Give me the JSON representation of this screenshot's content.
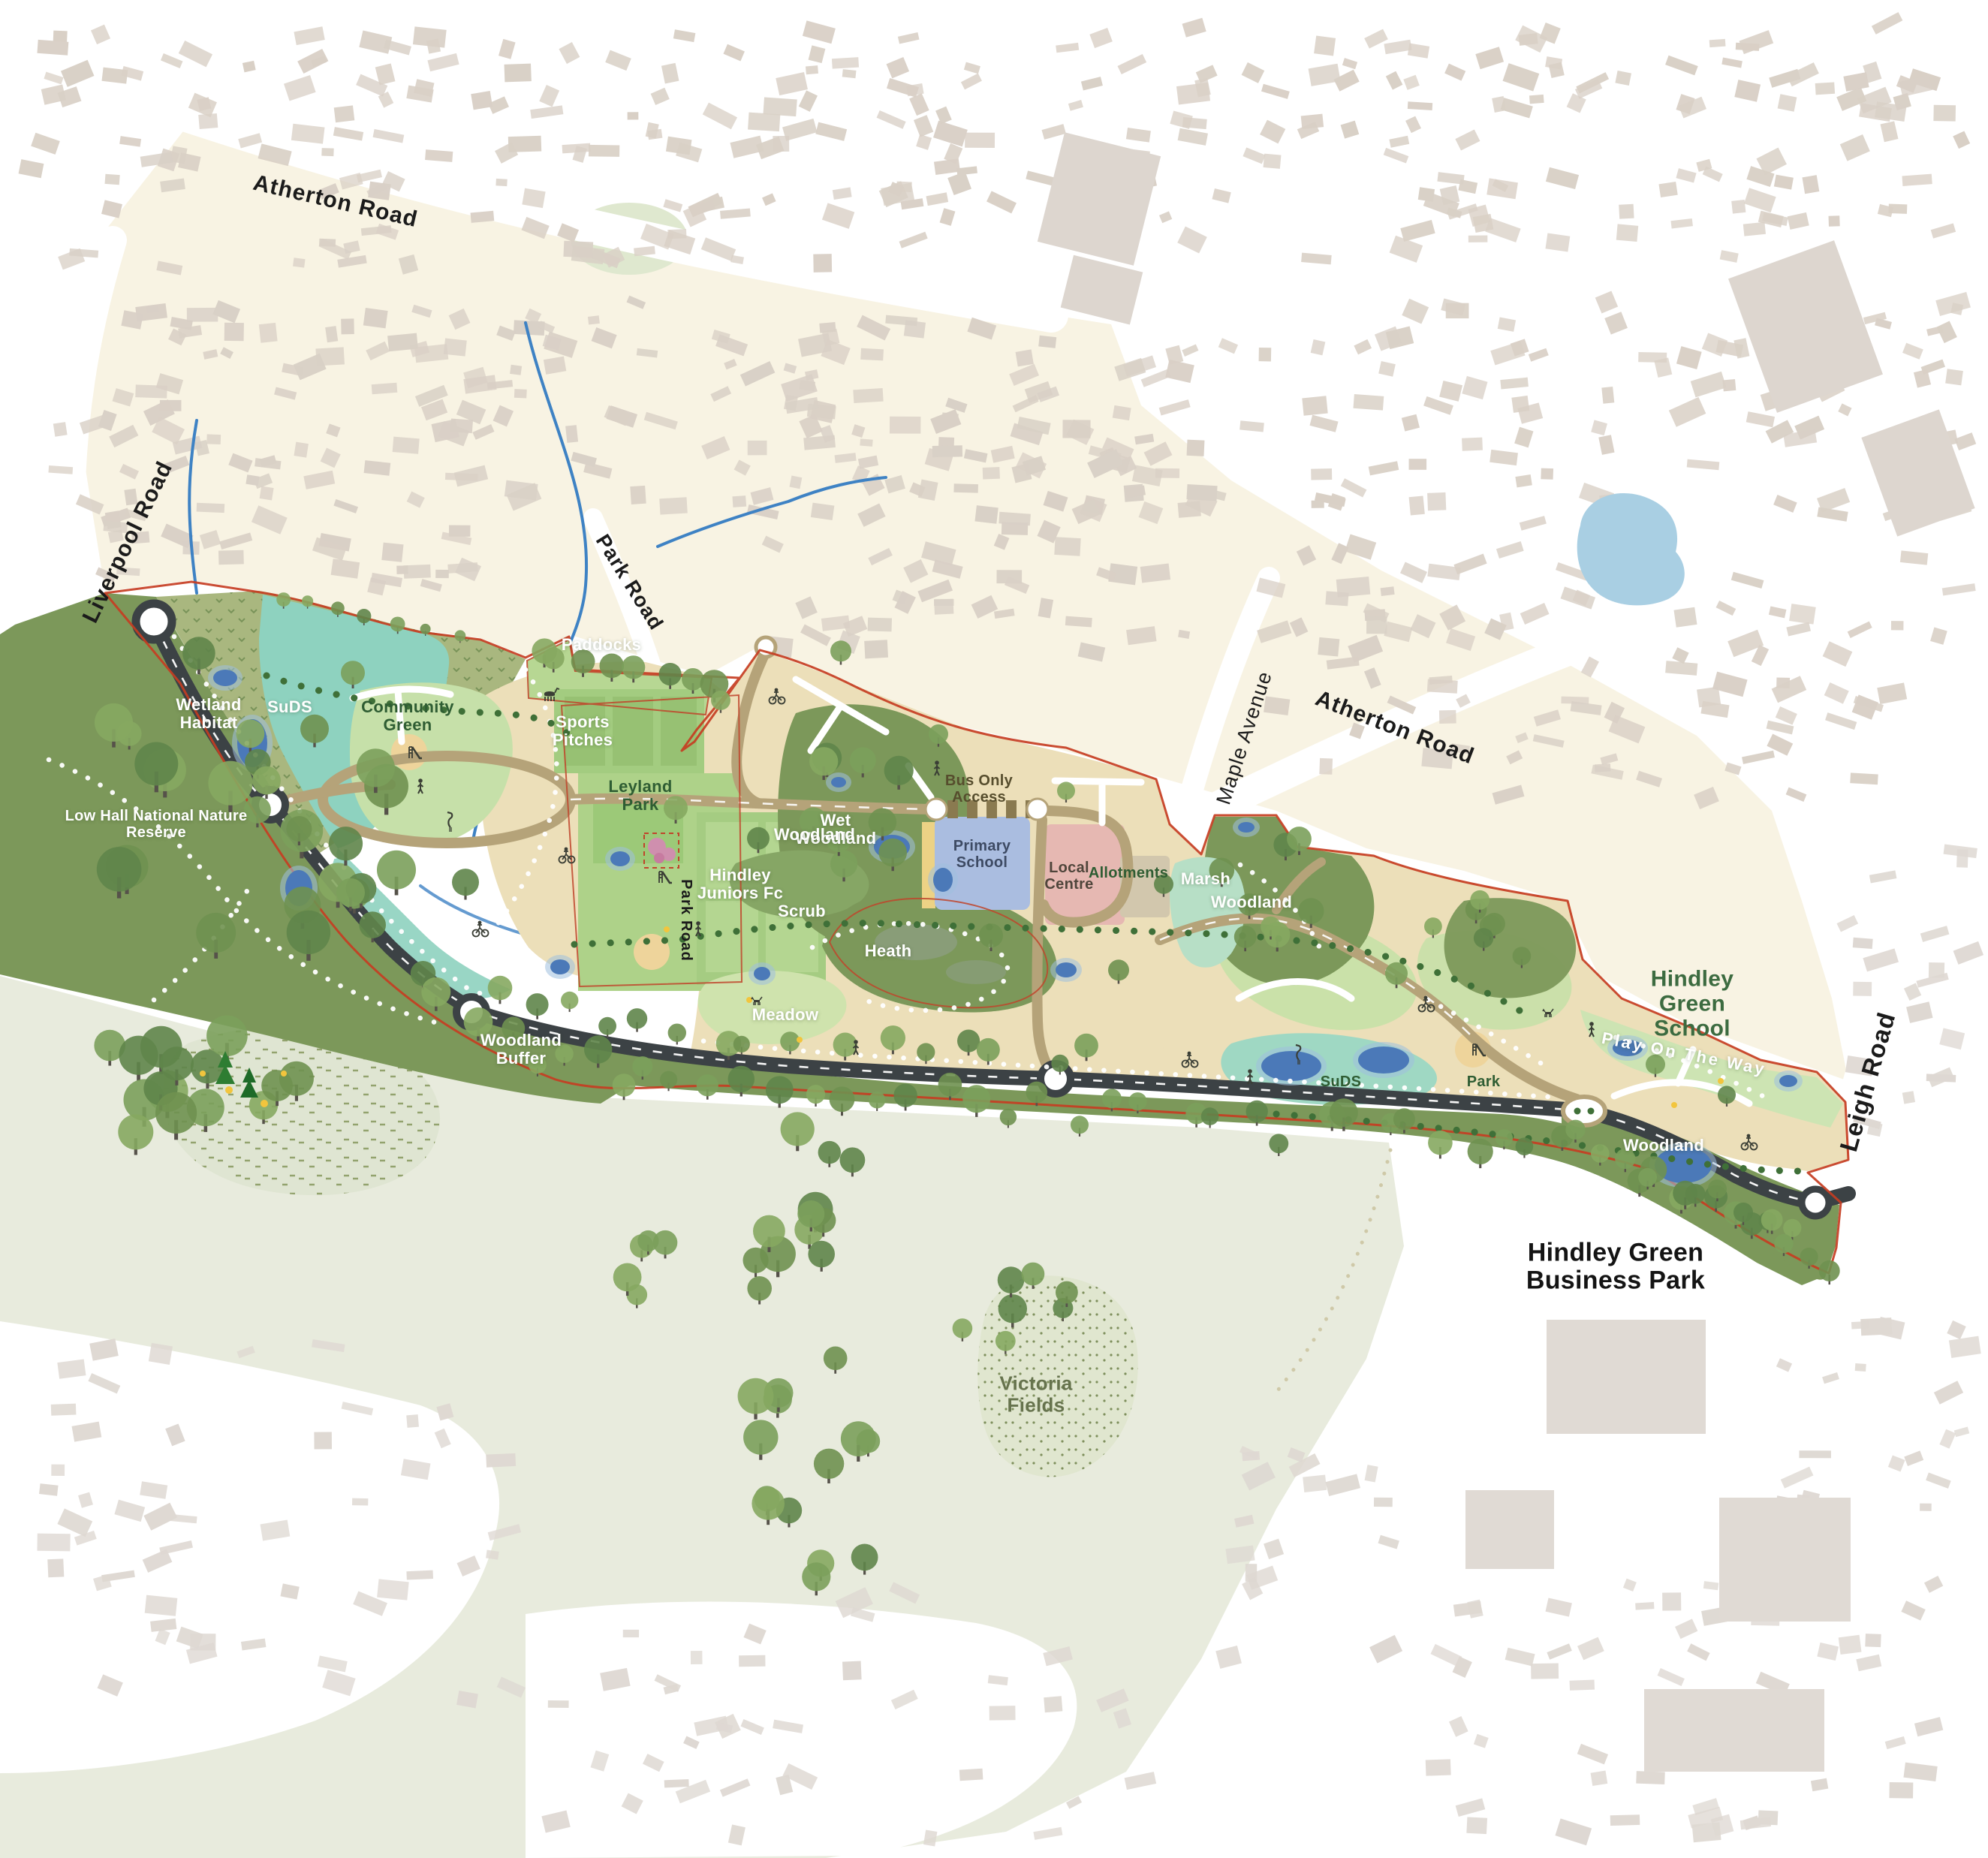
{
  "map_type": "illustrative-masterplan",
  "road_labels": {
    "atherton_road_west": "Atherton Road",
    "liverpool_road": "Liverpool Road",
    "park_road_upper": "Park Road",
    "park_road_lower": "Park Road",
    "maple_avenue": "Maple Avenue",
    "atherton_road_east": "Atherton Road",
    "leigh_road": "Leigh Road"
  },
  "site_labels": {
    "wetland_habitat": "Wetland Habitat",
    "suds_west": "SuDS",
    "community_green": "Community Green",
    "low_hall_reserve": "Low Hall National Nature Reserve",
    "paddocks": "Paddocks",
    "sports_pitches": "Sports Pitches",
    "leyland_park": "Leyland Park",
    "wet_woodland": "Wet Woodland",
    "hindley_juniors_fc": "Hindley Juniors Fc",
    "scrub": "Scrub",
    "heath": "Heath",
    "meadow": "Meadow",
    "bus_only_access": "Bus Only Access",
    "primary_school": "Primary School",
    "local_centre": "Local Centre",
    "allotments": "Allotments",
    "marsh": "Marsh",
    "woodland_north": "Woodland",
    "woodland_ne": "Woodland",
    "woodland_buffer": "Woodland Buffer",
    "suds_east": "SuDS",
    "park_east": "Park",
    "play_on_the_way": "Play On The Way",
    "woodland_se": "Woodland",
    "victoria_fields": "Victoria Fields"
  },
  "context_labels": {
    "hindley_green_school": "Hindley Green School",
    "hindley_green_business_park": "Hindley Green Business Park"
  },
  "colors": {
    "boundary_red": "#c63d22",
    "road_dark": "#3c4245",
    "road_tan": "#b5a379",
    "parcel_beige": "#ecdfb9",
    "woodland_olive": "#7c985a",
    "wetland_olive": "#a9b77f",
    "park_green": "#a5cc82",
    "park_light": "#cfe5b4",
    "wetland_teal": "#8ed2bf",
    "pond_blue": "#4b79b8",
    "lake_blue": "#a9cfe3",
    "school_blue": "#aabde0",
    "local_centre_pink": "#e6b8b2",
    "playground_sand": "#eed49b",
    "urban_cream": "#f8f3e3",
    "building_taupe": "#d9d0c6",
    "open_sage": "#e8ebdd",
    "dot_path_green": "#3f7038",
    "accent_yellow": "#f2c53d"
  }
}
